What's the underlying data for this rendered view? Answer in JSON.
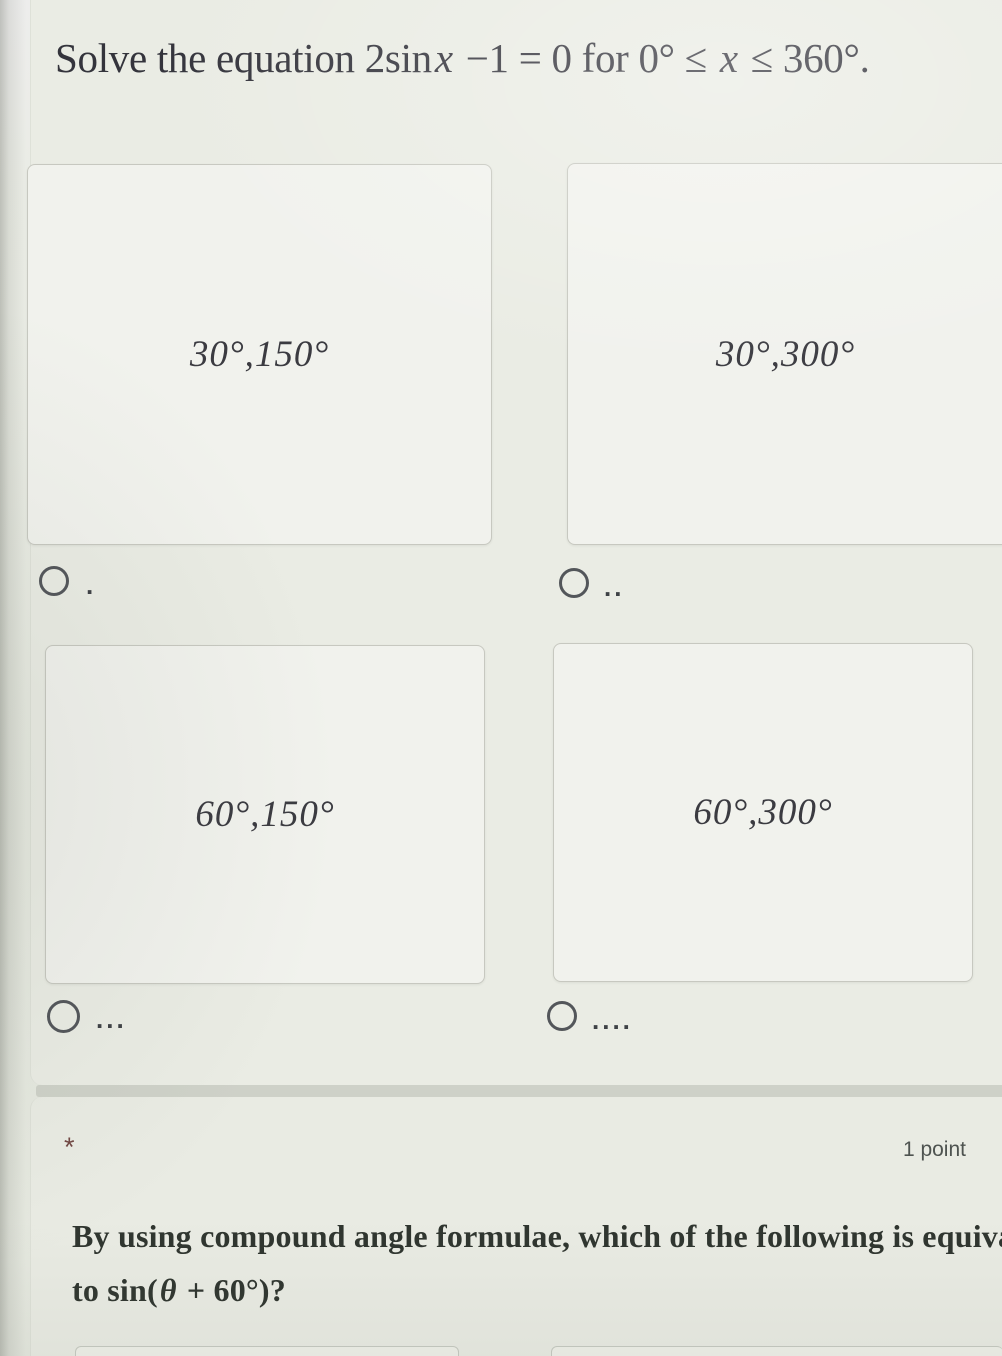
{
  "colors": {
    "page_background": "#e4e7de",
    "form_card_background": "#eaece4",
    "option_card_background": "#f1f2ed",
    "option_card_border": "#c7c8c0",
    "divider_band": "#ced1c8",
    "title_text": "#34343c",
    "option_text": "#3b3b41",
    "question_text": "#2f352f",
    "points_text": "#4e5350",
    "asterisk_color": "#714743",
    "radio_border": "#53565a"
  },
  "question1": {
    "title_segments": [
      {
        "text": "Solve the equation 2sin"
      },
      {
        "text": "x"
      },
      {
        "text": " −1 = 0 for 0° ≤ "
      },
      {
        "text": "x"
      },
      {
        "text": " ≤ 360°."
      }
    ],
    "options": [
      {
        "value": "30°,150°",
        "radio_label": ".",
        "selected": false
      },
      {
        "value": "30°,300°",
        "radio_label": "..",
        "selected": false
      },
      {
        "value": "60°,150°",
        "radio_label": "...",
        "selected": false
      },
      {
        "value": "60°,300°",
        "radio_label": "....",
        "selected": false
      }
    ]
  },
  "question2": {
    "required_marker": "*",
    "points_label": "1 point",
    "line1": "By using compound angle formulae, which of the following is equivalent",
    "line2_segments": [
      {
        "text": "to sin("
      },
      {
        "text": "θ"
      },
      {
        "text": " + 60°)?"
      }
    ]
  }
}
